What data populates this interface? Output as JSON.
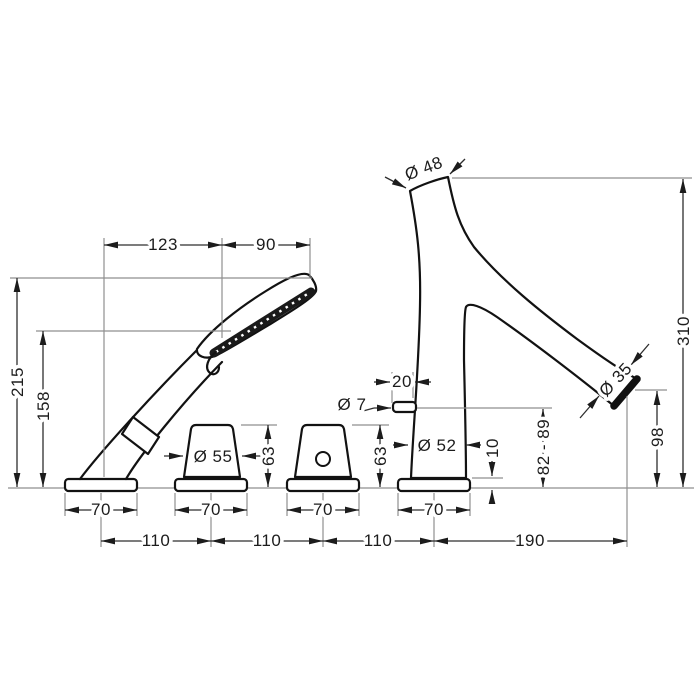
{
  "drawing": {
    "unit_note": "",
    "colors": {
      "outline": "#121212",
      "dimension": "#2e2e2e",
      "extension": "#8f8f8f",
      "background": "#ffffff"
    },
    "dims": {
      "top_span_left": "123",
      "top_span_right": "90",
      "shower_total_height": "215",
      "shower_spray_height": "158",
      "spout_top_diameter": "Ø 48",
      "spout_total_height": "310",
      "spout_outlet_diameter": "Ø 35",
      "spout_outlet_height": "98",
      "nub_offset": "20",
      "nub_diameter": "Ø 7",
      "handle_diameter": "Ø 55",
      "handle_height_left": "63",
      "handle_height_right": "63",
      "spout_base_diameter": "Ø 52",
      "escutcheon_height": "10",
      "deck_thickness_range": "82 - 89",
      "escutcheon_widths": [
        "70",
        "70",
        "70",
        "70"
      ],
      "hole_spacings": [
        "110",
        "110",
        "110"
      ],
      "spout_reach": "190"
    }
  }
}
